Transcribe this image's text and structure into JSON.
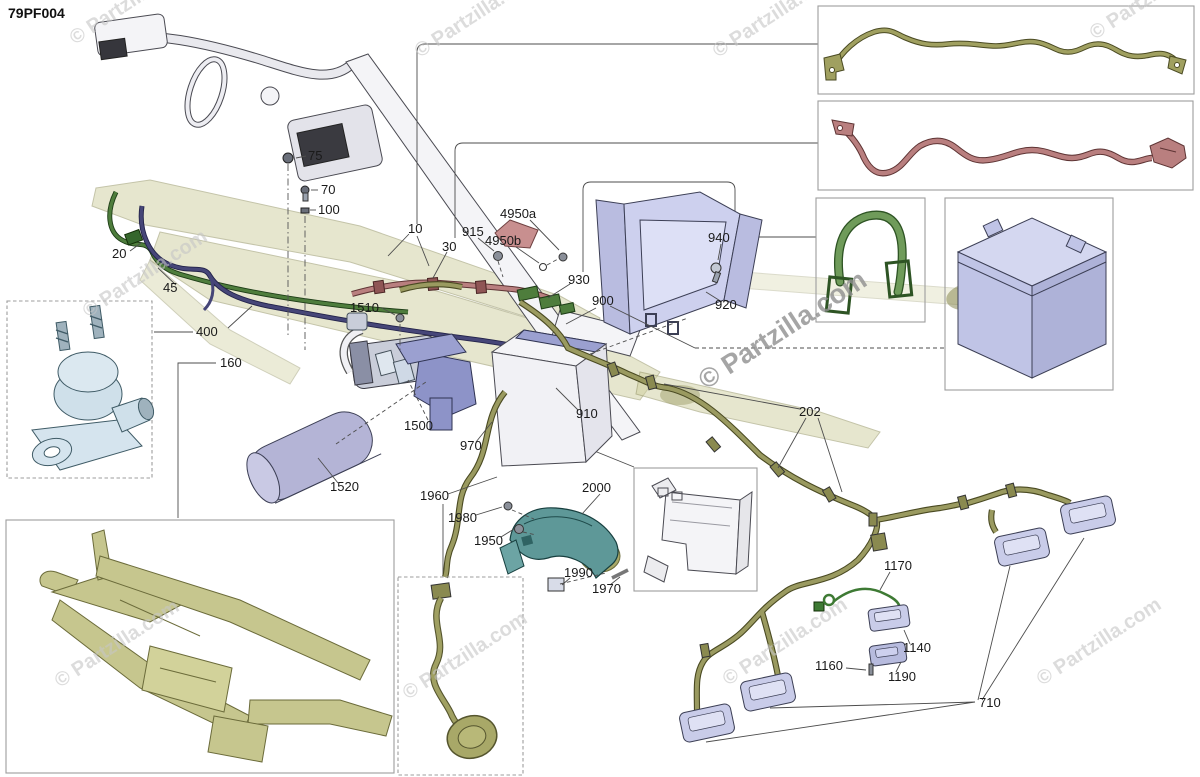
{
  "page": {
    "code": "79PF004",
    "watermark": "© Partzilla.com"
  },
  "colors": {
    "harness_olive": "#9a9a60",
    "harness_olive_dark": "#4a4a22",
    "cable_red": "#b97f7f",
    "strap_green": "#6f9b5a",
    "wire_green": "#4e7d3c",
    "wire_navy": "#464678",
    "part_lavender": "#c9cce9",
    "cover_teal": "#5e9898",
    "frame_olive": "#c6c68e",
    "solenoid_blue": "#d5e4ee",
    "watermark_gray": "#c6c6c6"
  },
  "callouts": [
    {
      "text": "75"
    },
    {
      "text": "70"
    },
    {
      "text": "100"
    },
    {
      "text": "20"
    },
    {
      "text": "45"
    },
    {
      "text": "400"
    },
    {
      "text": "160"
    },
    {
      "text": "1510"
    },
    {
      "text": "10"
    },
    {
      "text": "30"
    },
    {
      "text": "915"
    },
    {
      "text": "4950a"
    },
    {
      "text": "4950b"
    },
    {
      "text": "930"
    },
    {
      "text": "900"
    },
    {
      "text": "940"
    },
    {
      "text": "920"
    },
    {
      "text": "1500"
    },
    {
      "text": "970"
    },
    {
      "text": "910"
    },
    {
      "text": "1520"
    },
    {
      "text": "1960"
    },
    {
      "text": "1980"
    },
    {
      "text": "1950"
    },
    {
      "text": "2000"
    },
    {
      "text": "1990"
    },
    {
      "text": "1970"
    },
    {
      "text": "202"
    },
    {
      "text": "1170"
    },
    {
      "text": "1140"
    },
    {
      "text": "1160"
    },
    {
      "text": "1190"
    },
    {
      "text": "710"
    }
  ]
}
